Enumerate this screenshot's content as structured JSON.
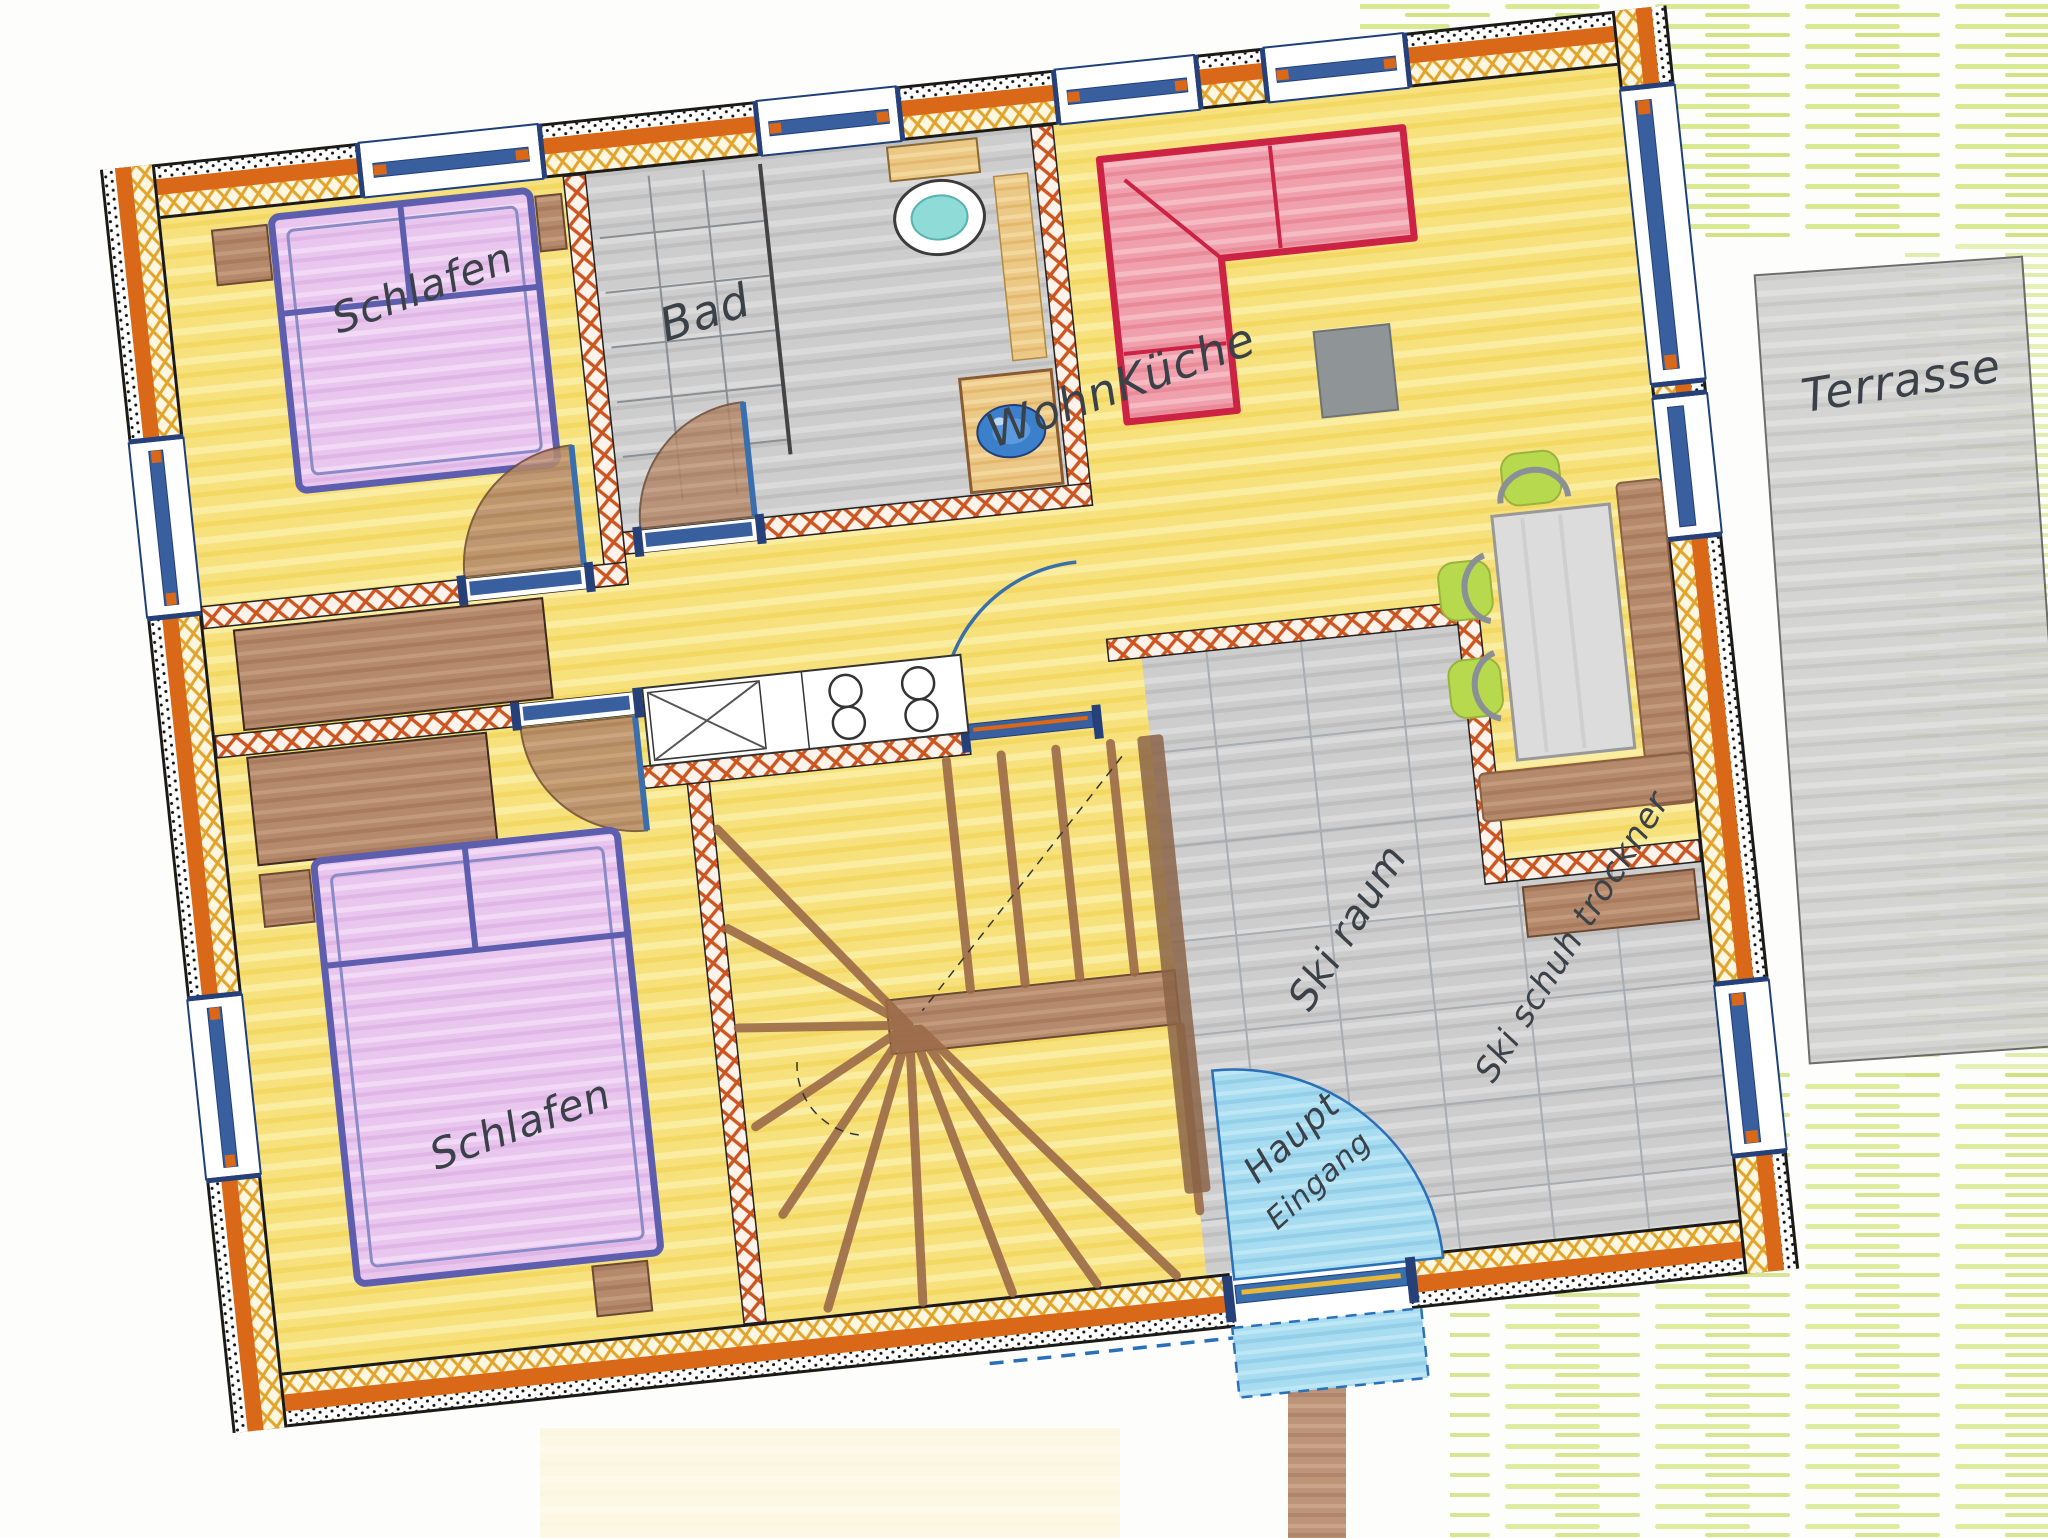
{
  "title": "Hand-drawn floor plan (ground floor)",
  "annotation": {
    "code": "RE 83"
  },
  "rooms": {
    "bedroom1": {
      "label": "Schlafen"
    },
    "bedroom2": {
      "label": "Schlafen"
    },
    "bathroom": {
      "label": "Bad"
    },
    "kitchen": {
      "label": "WohnKüche"
    },
    "terrace": {
      "label": "Terrasse"
    },
    "skiroom": {
      "label": "Ski raum",
      "dryer_label": "Ski schuh trockner"
    },
    "entrance": {
      "line1": "Haupt",
      "line2": "Eingang"
    }
  },
  "colors": {
    "wall_orange": "#d96818",
    "insulation_gold": "#e2a42a",
    "interior_wall_red": "#cc5520",
    "floor_yellow": "#f6e17c",
    "floor_gray": "#cdcdcd",
    "bed_lilac": "#e8c6ee",
    "bed_border_blue": "#5e5eae",
    "sofa_red": "#cc2244",
    "door_blue": "#3a6fae",
    "entry_light_blue": "#a8dcf0",
    "grass_green": "#cfe47a",
    "furniture_brown": "#b5896b",
    "handwriting_ink": "#3a4148"
  }
}
